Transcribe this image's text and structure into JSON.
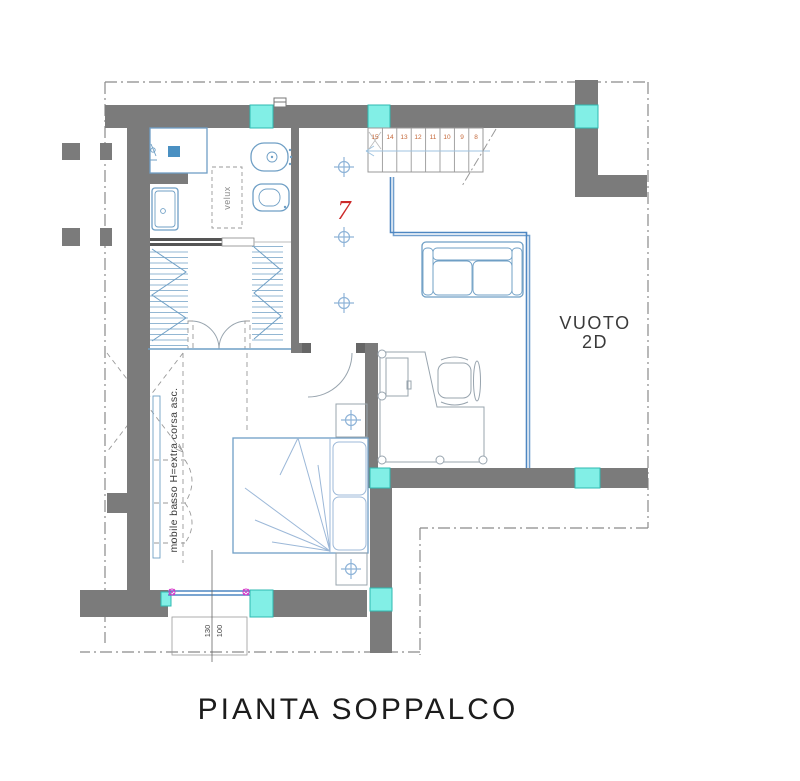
{
  "plan": {
    "title": "PIANTA SOPPALCO",
    "room_number": "7",
    "void_label": {
      "line1": "VUOTO",
      "line2": "2D"
    },
    "skylight_label": "velux",
    "cabinet_note": "mobile basso H=extra corsa asc.",
    "window_dimension": {
      "numerator": "130",
      "denominator": "100"
    },
    "stairs": {
      "steps": [
        "15",
        "14",
        "13",
        "12",
        "11",
        "10",
        "9",
        "8"
      ]
    },
    "colors": {
      "wall_gray": "#7b7b7b",
      "window_cyan": "#82efe6",
      "window_border_teal": "#2fb8b0",
      "furniture_blue": "#6f9fc5",
      "railing_blue": "#4e87c2",
      "step_number_orange": "#c4683a",
      "room_number_red": "#cc2a2a",
      "hinge_magenta": "#d633c8",
      "boundary_dash_gray": "#8a8a8a"
    }
  }
}
